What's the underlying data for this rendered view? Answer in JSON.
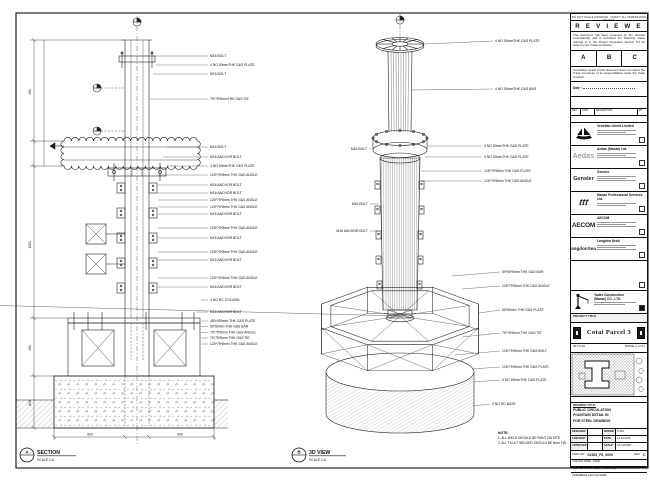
{
  "frame": {
    "edge_note": "DO NOT SCALE DRAWING. VERIFY ALL DIMENSIONS ON SITE"
  },
  "stamp": {
    "title": "R E V I E W E D",
    "body1": "This document has been reviewed by the relevant Consultant(s) and is accorded the following status referred  to  in the Project Procedure Section 5.4 for action by the Trade Contractor.",
    "options": [
      "A",
      "B",
      "C"
    ],
    "body2": "Consultant review of this document does not relieve the Trade Contractor of its responsibilities under the Trade Contract.",
    "date_label": "Date :"
  },
  "revision_table": {
    "headers": [
      "REV",
      "DATE",
      "DESCRIPTION",
      "BY"
    ]
  },
  "companies": [
    {
      "logo_text": "",
      "name": "Venetian Orient Limited"
    },
    {
      "logo_text": "Aedas",
      "name": "Aedas (Macau) Ltd."
    },
    {
      "logo_text": "Gensler",
      "name": "Gensler"
    },
    {
      "logo_text": "ttt",
      "name": "Macau Professional Services Ltd."
    },
    {
      "logo_text": "AECOM",
      "name": "AECOM"
    },
    {
      "logo_text": "LangdonSeah",
      "name": "Langdon Seah"
    }
  ],
  "contractor": {
    "name_line1": "Yadex Construction",
    "name_line2": "(Macau) CO., LTD."
  },
  "project": {
    "label": "PROJECT TITLE",
    "title": "Cotai Parcel 3"
  },
  "key_plan": {
    "label": "KEY PLAN",
    "right_label": "PARCEL 3, LOT 2"
  },
  "drawing_title": {
    "label": "DRAWING TITLE:",
    "line1": "PUBLIC CIRCULATION",
    "line2": "FOUNTAIN DETAIL IN",
    "line3": "FOR STEEL DRAWING"
  },
  "fields": {
    "designed_label": "DESIGNED",
    "designed": "-",
    "drawn_label": "DRAWN",
    "drawn": "LUND",
    "checked_label": "CHECKED",
    "checked": "-",
    "date_label": "DATE",
    "date": "14-10-2015",
    "approved_label": "APPROVED",
    "approved": "-",
    "scale_label": "SCALE",
    "scale": "AS SHOWN",
    "dwg_no_label": "DWG NO :",
    "dwg_no": "S1525_FS_0000",
    "rev_label": "REV :",
    "rev": "C",
    "file1": "CAD FILE NAME : S1525",
    "file2": "CAD FILE NAME : S1525_FS_0000.dwg",
    "file3": "REFERENCE CAD FILE NAME :"
  },
  "views": {
    "section": {
      "bubble_top": "A",
      "bubble_bottom": "-",
      "title": "SECTION",
      "scale": "SCALE 1:8"
    },
    "iso": {
      "bubble_top": "B",
      "bubble_bottom": "-",
      "title": "3D VIEW",
      "scale": "SCALE 1:8"
    }
  },
  "note": {
    "title": "NOTE:",
    "line1": "1. ALL WELD SHOULD BE PAINT ON SITE.",
    "line2": "2. ALL FILLET WELDED SHOULD BE 6mm FW."
  },
  "sec_callouts": [
    "M16 BOLT",
    "4 NO 50mmTHK G&S PLATE",
    "M16 BOLT",
    "75*75*8mmTHK G&S TIE",
    "M16 BOLT",
    "M16 ANCHOR BOLT",
    "4 NO 50mmTHK G&S PLATE",
    "125*75*8mm THK G&S ANGLE",
    "M16 ANCHOR BOLT",
    "M16 ANCHOR BOLT",
    "125*75*8mm THK G&S ANGLE",
    "125*75*8mm THK G&S ANGLE",
    "M16 ANCHOR BOLT",
    "125*75*8mm THK G&S ANGLE",
    "M16 ANCHOR BOLT",
    "125*75*8mm THK G&S ANGLE",
    "M16 ANCHOR BOLT",
    "125*75*8mm THK G&S ANGLE",
    "M16 ANCHOR BOLT",
    "4 NO RC COLUMN",
    "M16 ANCHOR BOLT",
    "450*450mm THK G&S PLATE",
    "50*50mm THK G&S BAR",
    "75*75*8mm THK G&S ANGLE",
    "75*75*8mm THK G&S TIE",
    "125*75*8mm THK G&S ANGLE"
  ],
  "iso_callouts": [
    "4 NO 50mmTHK G&S PLATE",
    "4 NO 50mmTHK G&S BAR",
    "4 NO 50mmTHK G&S PLATE",
    "4 NO 50mmTHK G&S PLATE",
    "125*75*8mm THK G&S PLATE",
    "125*75*8mm THK G&S ANGLE",
    "50*50*5mm THK G&S BAR",
    "125*75*8mm THK G&S ANGLE",
    "50*50mm THK G&S PLATE",
    "75*75*8mm THK G&S TIE",
    "125*75*8mm THK G&S BOLT",
    "125*75*8mm THK G&S PLATE",
    "4 NO 50mmTHK G&S PLATE",
    "4 NO RC BASE"
  ],
  "iso_left_callouts": [
    "M16 BOLT",
    "M16 BOLT",
    "M16 ANCHOR BOLT"
  ],
  "dims": {
    "left1": "450",
    "left2": "1250",
    "left3": "450",
    "left4": "600",
    "bottom1": "600",
    "bottom2": "600"
  }
}
